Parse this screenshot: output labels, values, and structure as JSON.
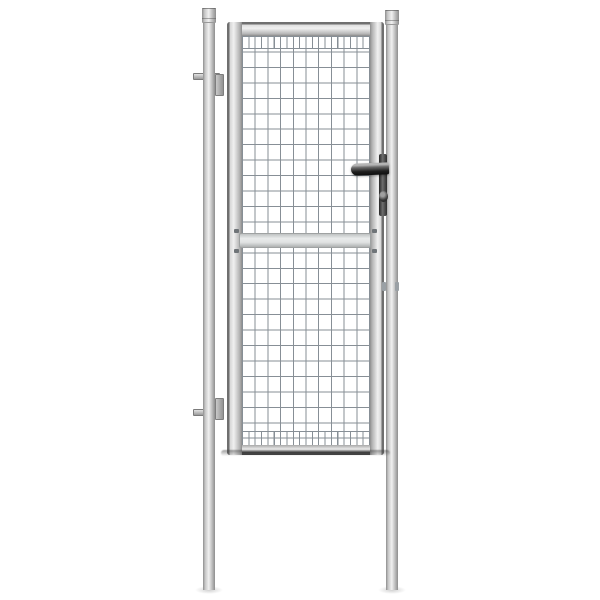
{
  "scene": {
    "type": "product-photo",
    "description": "Galvanised steel garden gate with welded wire mesh panel, set between two round posts with caps, fitted with a black lever handle lock, a middle crossbar and two adjustable hinges, photographed on a plain white background",
    "background_color": "#ffffff"
  },
  "colors": {
    "bg": "#ffffff",
    "metal-light": "#f0f0f0",
    "metal-mid": "#c6c6c6",
    "metal-edge": "#8e8e8e",
    "frame-outline": "#6f6f6f",
    "wire": "#878f96",
    "crossbar-light": "#e9ebeb",
    "crossbar-dark": "#aeb1b1",
    "hardware-dark": "#1f1f1f",
    "hardware-mid": "#6e6e6e",
    "hinge-gray": "#c9c9c9",
    "shadow": "rgba(0,0,0,0.18)"
  },
  "objects": {
    "posts": {
      "count": 2,
      "shape": "round tube with cap",
      "finish": "galvanised silver"
    },
    "gate_frame": {
      "shape": "rounded rectangular tube",
      "finish": "galvanised silver"
    },
    "mesh": {
      "pattern": "rectangular grid",
      "cell_width_px": 12.7,
      "cell_height_px": 15.5,
      "edge_rows": "double-density vertical wires at top and bottom rows"
    },
    "hardware_parts": [
      "lever-handle",
      "lock-plate",
      "lock-cylinder",
      "top-hinge",
      "bottom-hinge",
      "middle-crossbar",
      "crossbar-clips",
      "latch-keeper"
    ]
  }
}
